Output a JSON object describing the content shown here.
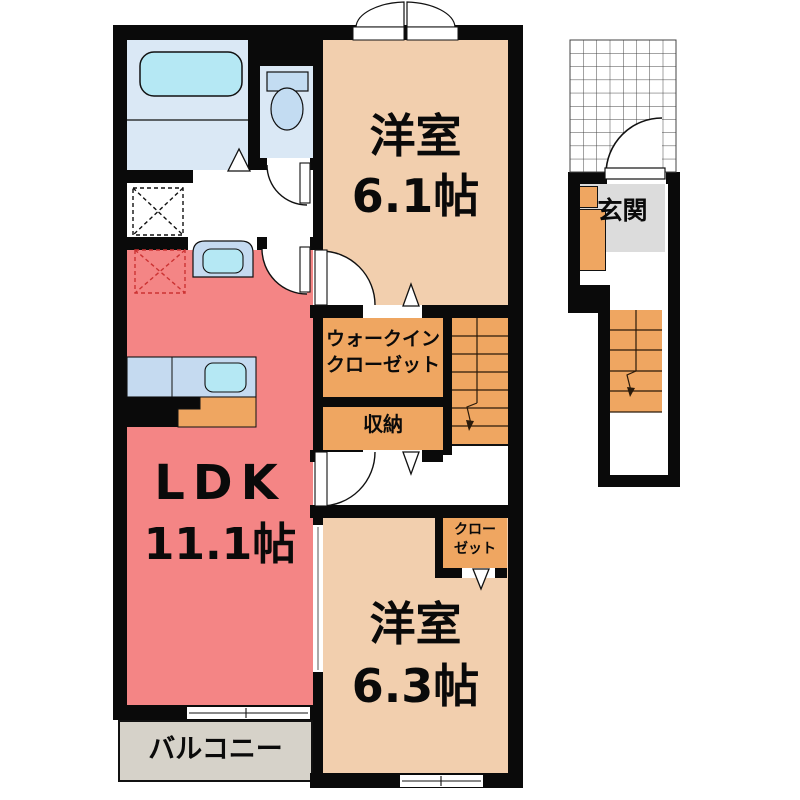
{
  "plan": {
    "ldk": {
      "name": "LDK",
      "size": "11.1帖"
    },
    "bedroom_upper": {
      "name": "洋室",
      "size": "6.1帖"
    },
    "bedroom_lower": {
      "name": "洋室",
      "size": "6.3帖"
    },
    "walk_in_closet": {
      "line1": "ウォークイン",
      "line2": "クローゼット"
    },
    "storage": {
      "label": "収納"
    },
    "closet": {
      "line1": "クロー",
      "line2": "ゼット"
    },
    "balcony": {
      "label": "バルコニー"
    },
    "entrance": {
      "label": "玄関"
    }
  },
  "colors": {
    "wall": "#0a0a0a",
    "ldk": "#f48585",
    "bedroom": "#f2cfae",
    "orange": "#efa661",
    "bath": "#dae8f5",
    "fixture": "#c5daf0",
    "water": "#b5e8f4",
    "genkan": "#dcdcdc",
    "balcony": "#d6d2c9",
    "fridge_dash": "#cc3333"
  }
}
